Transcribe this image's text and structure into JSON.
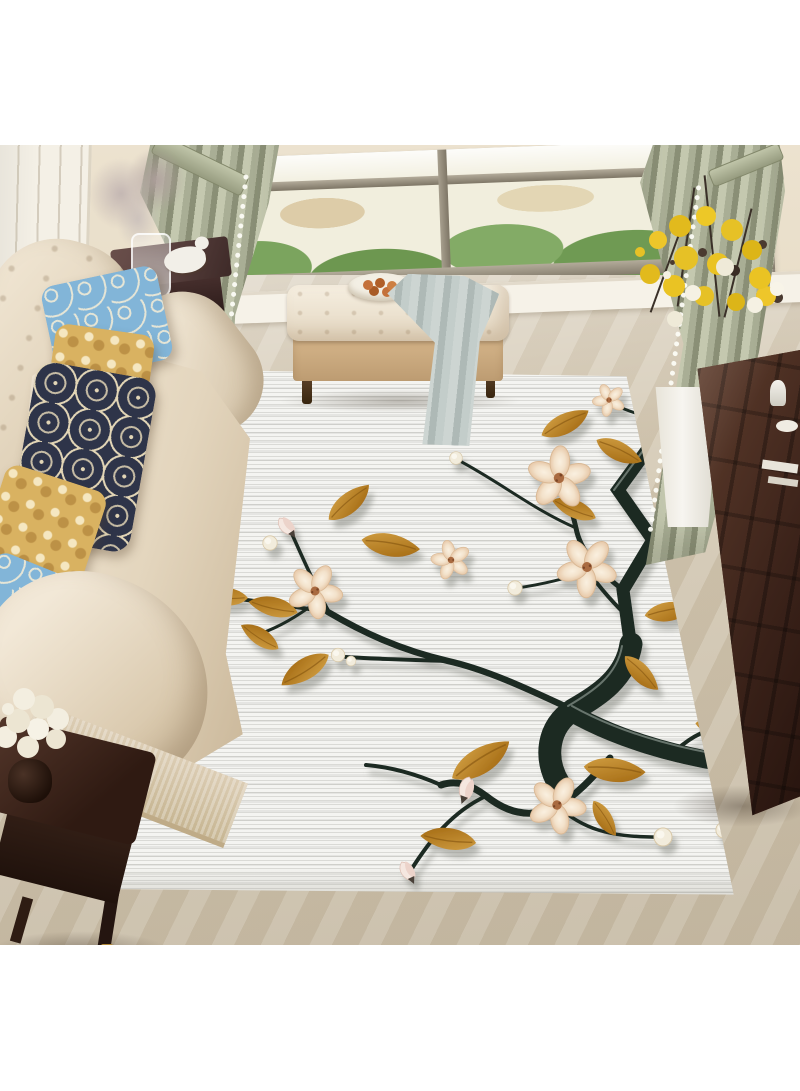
{
  "image": {
    "type": "product-photo",
    "subject": "white area rug printed with dark blossom branches styled in a living room",
    "visible_text": "none"
  },
  "scene": {
    "room": "living room",
    "objects": [
      {
        "name": "window",
        "details": "large grey-taupe framed window overlooking green trees, rooftops and distant buildings"
      },
      {
        "name": "curtains",
        "details": "sage green curtains tied back on the left and right of the window"
      },
      {
        "name": "sofa",
        "details": "cream tufted sofa along the left with five decorative pillows"
      },
      {
        "name": "pillows",
        "details": "light blue scroll pattern, gold damask, navy-and-cream damask, gold damask, light blue pattern"
      },
      {
        "name": "bench",
        "details": "cream tufted ottoman bench with tan base, plate of small orange fruits and a grey-blue throw draped over it"
      },
      {
        "name": "side-table",
        "details": "dark wood side table behind the sofa holding a glass vase of dried grey flowers and a white dog figurine"
      },
      {
        "name": "floor-vase",
        "details": "tall white tapered vase with yellow and white flowers on dark twigs"
      },
      {
        "name": "cabinet",
        "details": "dark carved wood cabinet on the right with white dishes"
      },
      {
        "name": "end-table",
        "details": "dark wood end table with a white flower bouquet at bottom left"
      },
      {
        "name": "rug",
        "details": "white striated area rug printed with dark gnarled branches, golden leaves, cream blossoms, pink buds and pale round buds"
      },
      {
        "name": "floor",
        "details": "beige marble floor"
      }
    ],
    "rug_art": {
      "branch_color_name": "dark green-black",
      "flowers": 6,
      "pink_buds": 3,
      "round_buds": 8,
      "golden_leaves": 16
    }
  },
  "colors": {
    "background": "#ffffff",
    "wall": "#e9dfcc",
    "wainscoting": "#f4f0e6",
    "window_frame": "#8f8779",
    "view_base": "#f1eedd",
    "view_foliage": "#6f9a53",
    "curtain": "#a9ae95",
    "curtain_light": "#c4c8af",
    "curtain_dark": "#8a8f76",
    "sofa": "#ebdfcc",
    "sofa_skirt": "#d9cbb2",
    "pillow_blue": "#82b5d8",
    "pillow_gold": "#d9b261",
    "pillow_navy": "#2e3449",
    "bench_top": "#f1e8d8",
    "bench_base": "#c9a97d",
    "blanket": "#bfc9c6",
    "fruit": "#c4713a",
    "plate": "#f3efe4",
    "floor": "#d2c6b0",
    "rug_base": "#f4f4f1",
    "branch": "#1d2a24",
    "branch_highlight": "#76837a",
    "leaf_light": "#cf9a3a",
    "leaf_dark": "#a0660f",
    "petal_light": "#f8ead6",
    "petal_dark": "#e7c8a8",
    "flower_center": "#a96b40",
    "bud": "#f2ecdc",
    "pink_bud": "#f5e7e0",
    "wood_dark": "#2f1a12",
    "wood_mid": "#59392b",
    "table_maroon": "#5d4441",
    "dried_flower": "#c1b4b1",
    "dog_white": "#f2efe8",
    "vase_white": "#f7f5f0",
    "flower_yellow": "#e6c126",
    "flower_white": "#f5f1e3",
    "twig_dark": "#3a3028",
    "handle_gold": "#c9a040"
  }
}
